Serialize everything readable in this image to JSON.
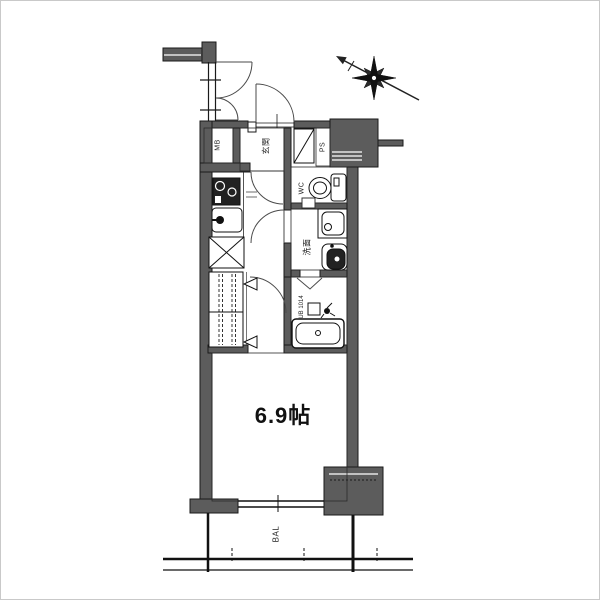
{
  "plan": {
    "room_size_label": "6.9帖",
    "rooms": {
      "genkan": "玄関",
      "wc": "WC",
      "washroom": "洗面",
      "bath": "UB 1014",
      "balcony": "BAL",
      "pipe_space": "PS",
      "meter_box": "MB"
    },
    "colors": {
      "wall_fill": "#5c5c5c",
      "line": "#1a1a1a",
      "background": "#ffffff",
      "frame_border": "#c9c9c9"
    }
  }
}
